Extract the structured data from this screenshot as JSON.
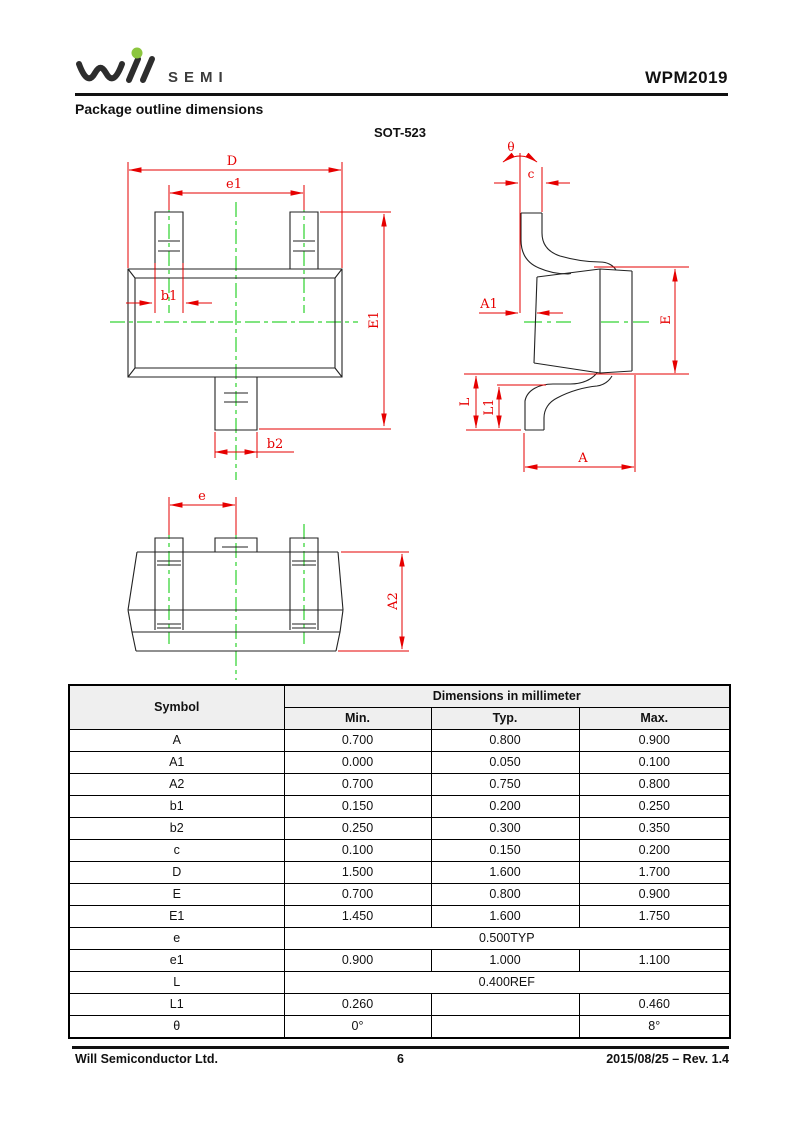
{
  "header": {
    "logo_text": "SEMI",
    "part_number": "WPM2019"
  },
  "page": {
    "section_title": "Package outline dimensions",
    "package_name": "SOT-523"
  },
  "drawing": {
    "labels": {
      "D": "D",
      "e1": "e1",
      "b1": "b1",
      "b2": "b2",
      "E1": "E1",
      "theta": "θ",
      "c": "c",
      "A1": "A1",
      "E": "E",
      "L": "L",
      "L1": "L1",
      "A": "A",
      "e": "e",
      "A2": "A2"
    },
    "colors": {
      "dimension_red": "#e60000",
      "centerline_green": "#00c800",
      "outline_black": "#222222"
    }
  },
  "table": {
    "header": {
      "symbol": "Symbol",
      "group": "Dimensions in millimeter",
      "columns": [
        "Min.",
        "Typ.",
        "Max."
      ]
    },
    "rows": [
      {
        "symbol": "A",
        "min": "0.700",
        "typ": "0.800",
        "max": "0.900"
      },
      {
        "symbol": "A1",
        "min": "0.000",
        "typ": "0.050",
        "max": "0.100"
      },
      {
        "symbol": "A2",
        "min": "0.700",
        "typ": "0.750",
        "max": "0.800"
      },
      {
        "symbol": "b1",
        "min": "0.150",
        "typ": "0.200",
        "max": "0.250"
      },
      {
        "symbol": "b2",
        "min": "0.250",
        "typ": "0.300",
        "max": "0.350"
      },
      {
        "symbol": "c",
        "min": "0.100",
        "typ": "0.150",
        "max": "0.200"
      },
      {
        "symbol": "D",
        "min": "1.500",
        "typ": "1.600",
        "max": "1.700"
      },
      {
        "symbol": "E",
        "min": "0.700",
        "typ": "0.800",
        "max": "0.900"
      },
      {
        "symbol": "E1",
        "min": "1.450",
        "typ": "1.600",
        "max": "1.750"
      },
      {
        "symbol": "e",
        "span": "0.500TYP"
      },
      {
        "symbol": "e1",
        "min": "0.900",
        "typ": "1.000",
        "max": "1.100"
      },
      {
        "symbol": "L",
        "span": "0.400REF"
      },
      {
        "symbol": "L1",
        "min": "0.260",
        "typ": "",
        "max": "0.460"
      },
      {
        "symbol": "θ",
        "min": "0°",
        "typ": "",
        "max": "8°"
      }
    ]
  },
  "footer": {
    "company": "Will Semiconductor Ltd.",
    "page": "6",
    "revision": "2015/08/25 – Rev. 1.4"
  }
}
